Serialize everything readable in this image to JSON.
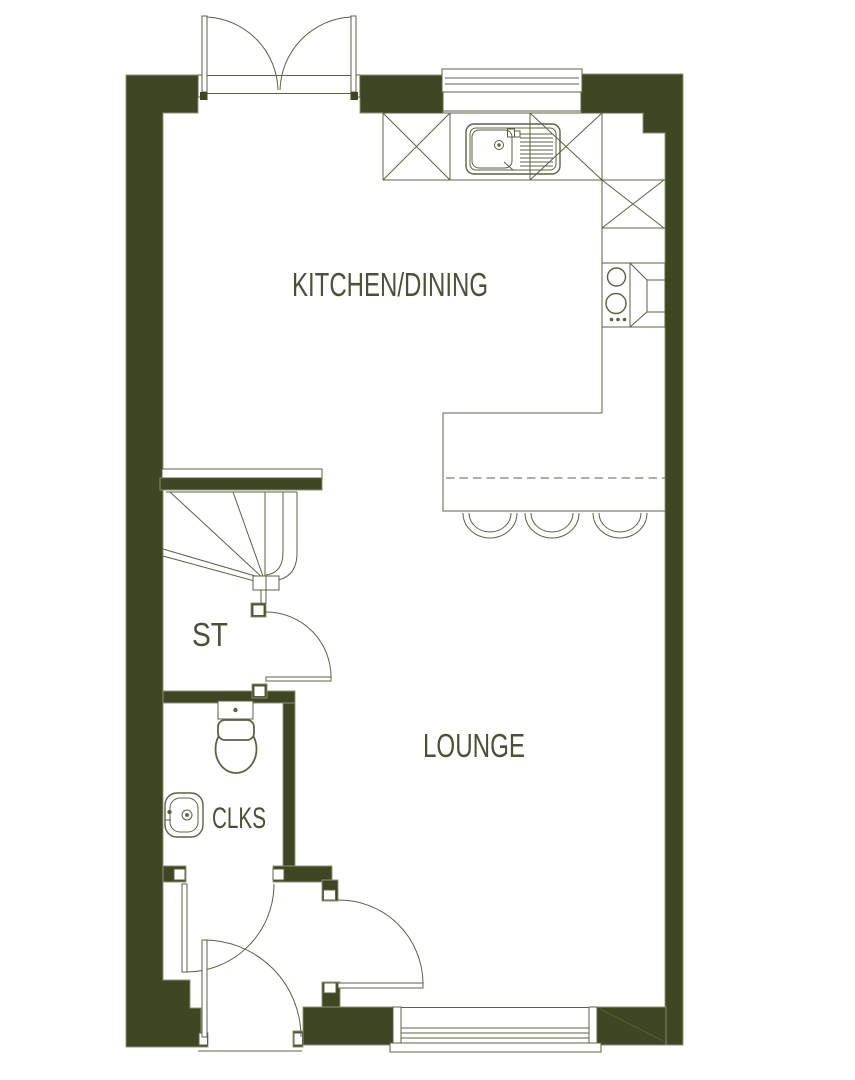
{
  "floorplan": {
    "rooms": [
      {
        "id": "kitchen-dining",
        "label": "KITCHEN/DINING"
      },
      {
        "id": "lounge",
        "label": "LOUNGE"
      },
      {
        "id": "stairs",
        "label": "ST"
      },
      {
        "id": "cloakroom",
        "label": "CLKS"
      }
    ],
    "colors": {
      "wall": "#3f4622",
      "wall_edge": "#8f9279",
      "line": "#5c6144",
      "label": "#4b5138",
      "background": "#ffffff"
    },
    "fixtures": [
      {
        "id": "french-doors",
        "room": "kitchen-dining"
      },
      {
        "id": "kitchen-window",
        "room": "kitchen-dining"
      },
      {
        "id": "sink-with-drainer",
        "room": "kitchen-dining"
      },
      {
        "id": "base-units",
        "room": "kitchen-dining"
      },
      {
        "id": "hob",
        "room": "kitchen-dining"
      },
      {
        "id": "extractor",
        "room": "kitchen-dining"
      },
      {
        "id": "breakfast-bar",
        "room": "kitchen-dining"
      },
      {
        "id": "bar-stools",
        "count": 3,
        "room": "kitchen-dining"
      },
      {
        "id": "winder-staircase",
        "room": "stairs"
      },
      {
        "id": "st-door",
        "room": "stairs"
      },
      {
        "id": "wc",
        "room": "cloakroom"
      },
      {
        "id": "wash-basin",
        "room": "cloakroom"
      },
      {
        "id": "clks-door",
        "room": "cloakroom"
      },
      {
        "id": "lounge-door",
        "room": "lounge"
      },
      {
        "id": "lounge-window",
        "room": "lounge"
      },
      {
        "id": "front-door",
        "room": "hall"
      }
    ]
  }
}
